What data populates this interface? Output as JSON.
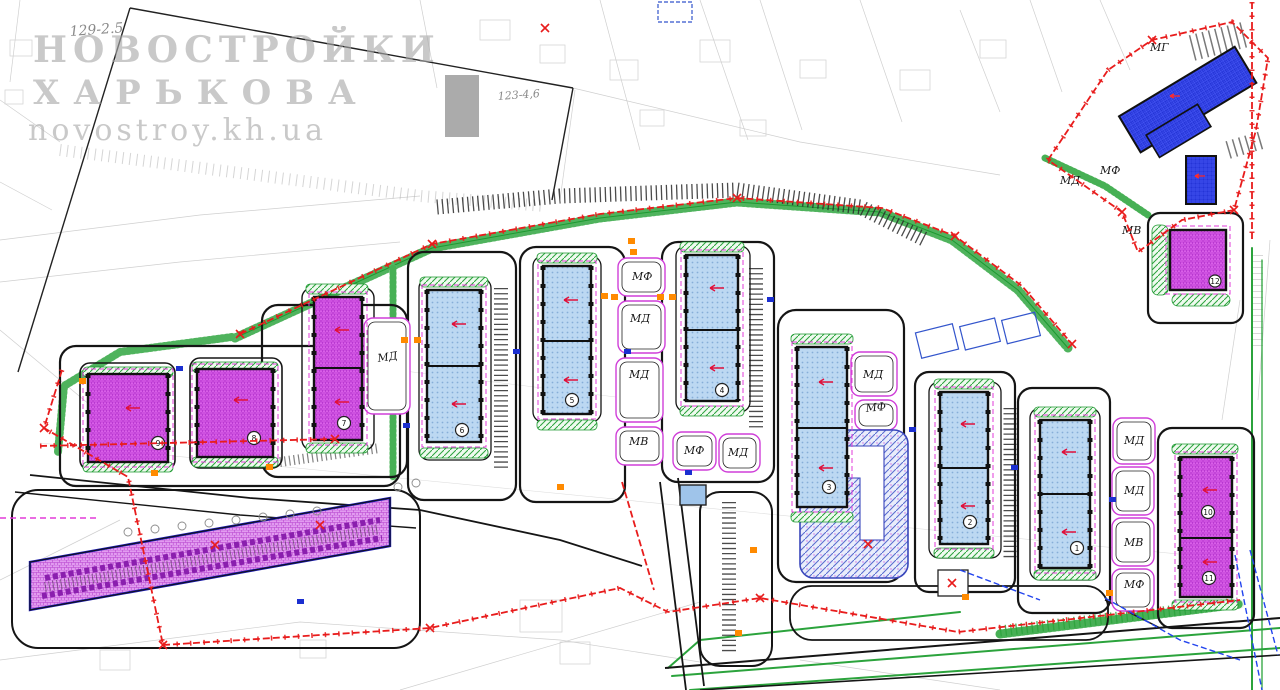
{
  "watermark": {
    "line1": "НОВОСТРОЙКИ",
    "line2": "ХАРЬКОВА",
    "line3": "novostroy.kh.ua"
  },
  "notes": {
    "parcel_1": "129-2.5",
    "parcel_2": "123-4,6"
  },
  "plot_labels": [
    {
      "label": "МД"
    },
    {
      "label": "МФ"
    },
    {
      "label": "МД"
    },
    {
      "label": "МД"
    },
    {
      "label": "МВ"
    },
    {
      "label": "МФ"
    },
    {
      "label": "МД"
    },
    {
      "label": "МД"
    },
    {
      "label": "МФ"
    },
    {
      "label": "МД"
    },
    {
      "label": "МД"
    },
    {
      "label": "МВ"
    },
    {
      "label": "МФ"
    },
    {
      "label": "МВ"
    },
    {
      "label": "МД"
    },
    {
      "label": "МФ"
    },
    {
      "label": "МГ"
    }
  ],
  "building_numbers": {
    "m9": "9",
    "m8": "8",
    "m7": "7",
    "t6": "6",
    "t5": "5",
    "t4": "4",
    "t3": "3",
    "t2": "2",
    "t1": "1",
    "m10": "10",
    "m11": "11",
    "m12": "12"
  },
  "colors": {
    "building_magenta": "#d95fe8",
    "building_blue": "#bcd8f2",
    "building_navy": "#2434d6",
    "landscape_green": "#2ba33c",
    "boundary_red": "#e81c1c",
    "marker_orange": "#ff8a00",
    "watermark_gray": "#a9a9a9"
  }
}
